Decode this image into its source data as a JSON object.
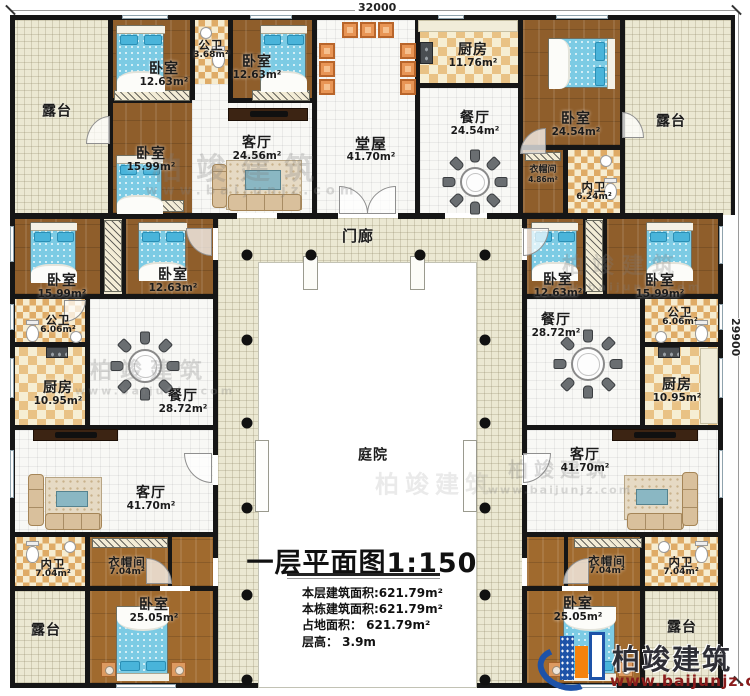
{
  "dimensions": {
    "top": "32000",
    "right": "29900"
  },
  "rooms": {
    "terraceTL": {
      "name": "露台"
    },
    "bedA": {
      "name": "卧室",
      "area": "12.63m²"
    },
    "bathA": {
      "name": "公卫",
      "area": "3.68m²"
    },
    "bedB": {
      "name": "卧室",
      "area": "12.63m²"
    },
    "bedC": {
      "name": "卧室",
      "area": "15.99m²"
    },
    "livingA": {
      "name": "客厅",
      "area": "24.56m²"
    },
    "hall": {
      "name": "堂屋",
      "area": "41.70m²"
    },
    "kitchenA": {
      "name": "厨房",
      "area": "11.76m²"
    },
    "diningA": {
      "name": "餐厅",
      "area": "24.54m²"
    },
    "bedD": {
      "name": "卧室",
      "area": "24.54m²"
    },
    "closetA": {
      "name": "衣帽间",
      "area": "4.86m²"
    },
    "bathB": {
      "name": "内卫",
      "area": "6.24m²"
    },
    "terraceTR": {
      "name": "露台"
    },
    "porch": {
      "name": "门廊"
    },
    "bedE": {
      "name": "卧室",
      "area": "15.99m²"
    },
    "bedF": {
      "name": "卧室",
      "area": "12.63m²"
    },
    "bathC": {
      "name": "公卫",
      "area": "6.06m²"
    },
    "kitchenB": {
      "name": "厨房",
      "area": "10.95m²"
    },
    "diningB": {
      "name": "餐厅",
      "area": "28.72m²"
    },
    "livingB": {
      "name": "客厅",
      "area": "41.70m²"
    },
    "bathD": {
      "name": "内卫",
      "area": "7.04m²"
    },
    "closetB": {
      "name": "衣帽间",
      "area": "7.04m²"
    },
    "bedG": {
      "name": "卧室",
      "area": "25.05m²"
    },
    "terraceBL": {
      "name": "露台"
    },
    "bedH": {
      "name": "卧室",
      "area": "12.63m²"
    },
    "bedI": {
      "name": "卧室",
      "area": "15.99m²"
    },
    "diningC": {
      "name": "餐厅",
      "area": "28.72m²"
    },
    "bathE": {
      "name": "公卫",
      "area": "6.06m²"
    },
    "kitchenC": {
      "name": "厨房",
      "area": "10.95m²"
    },
    "livingC": {
      "name": "客厅",
      "area": "41.70m²"
    },
    "closetC": {
      "name": "衣帽间",
      "area": "7.04m²"
    },
    "bathF": {
      "name": "内卫",
      "area": "7.04m²"
    },
    "bedJ": {
      "name": "卧室",
      "area": "25.05m²"
    },
    "terraceBR": {
      "name": "露台"
    },
    "courtyard": {
      "name": "庭院"
    }
  },
  "titleBlock": {
    "title": "一层平面图1:150",
    "lines": [
      "本层建筑面积:621.79m²",
      "本栋建筑面积:621.79m²",
      "占地面积： 621.79m²",
      "层高： 3.9m"
    ]
  },
  "logo": {
    "brand": "柏竣建筑",
    "url": "www.baijunjz.com"
  },
  "watermark": {
    "brand": "柏竣建筑",
    "url": "www.baijunjz.com"
  },
  "colors": {
    "wall": "#161616",
    "wood": "#8f5e2b",
    "terrace": "#ebe8d2",
    "tile": "#f8f8f5",
    "checker_tan": "#e9c285",
    "bed_blue": "#7ccbe4",
    "chair_orange": "#e89555",
    "logo_blue": "#1d52a8",
    "logo_orange": "#f5820b",
    "logo_url_red": "#8a1c1c"
  }
}
